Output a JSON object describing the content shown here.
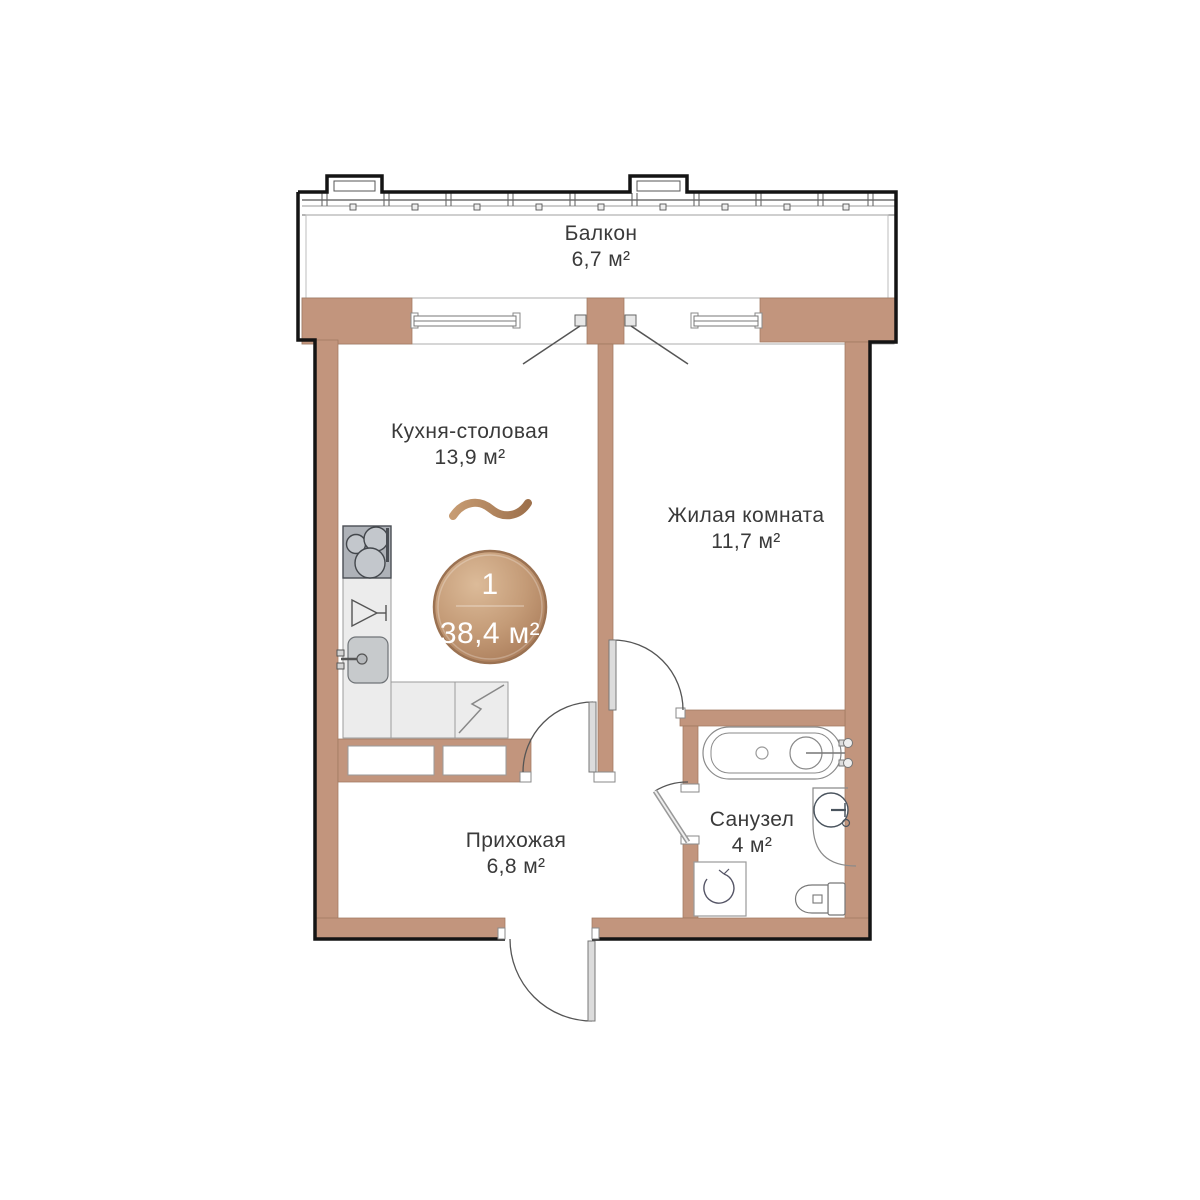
{
  "plan": {
    "type": "apartment-floor-plan",
    "badge": {
      "rooms_count": "1",
      "total_area": "38,4 м²"
    },
    "rooms": [
      {
        "name": "Балкон",
        "area": "6,7 м²"
      },
      {
        "name": "Кухня-столовая",
        "area": "13,9 м²"
      },
      {
        "name": "Жилая комната",
        "area": "11,7 м²"
      },
      {
        "name": "Прихожая",
        "area": "6,8 м²"
      },
      {
        "name": "Санузел",
        "area": "4 м²"
      }
    ],
    "fixtures": [
      "stove",
      "dishwasher",
      "sink",
      "refrigerator",
      "bathtub",
      "washbasin",
      "toilet",
      "washing-machine"
    ],
    "colors": {
      "wall": "#C2957D",
      "exterior_outline": "#141414",
      "badge_gradient_from": "#DCBB99",
      "badge_gradient_to": "#A87A58",
      "accent_wave": "#B98A62",
      "fixture_fill": "#ECECEC",
      "label_text": "#3A3A3A"
    }
  }
}
